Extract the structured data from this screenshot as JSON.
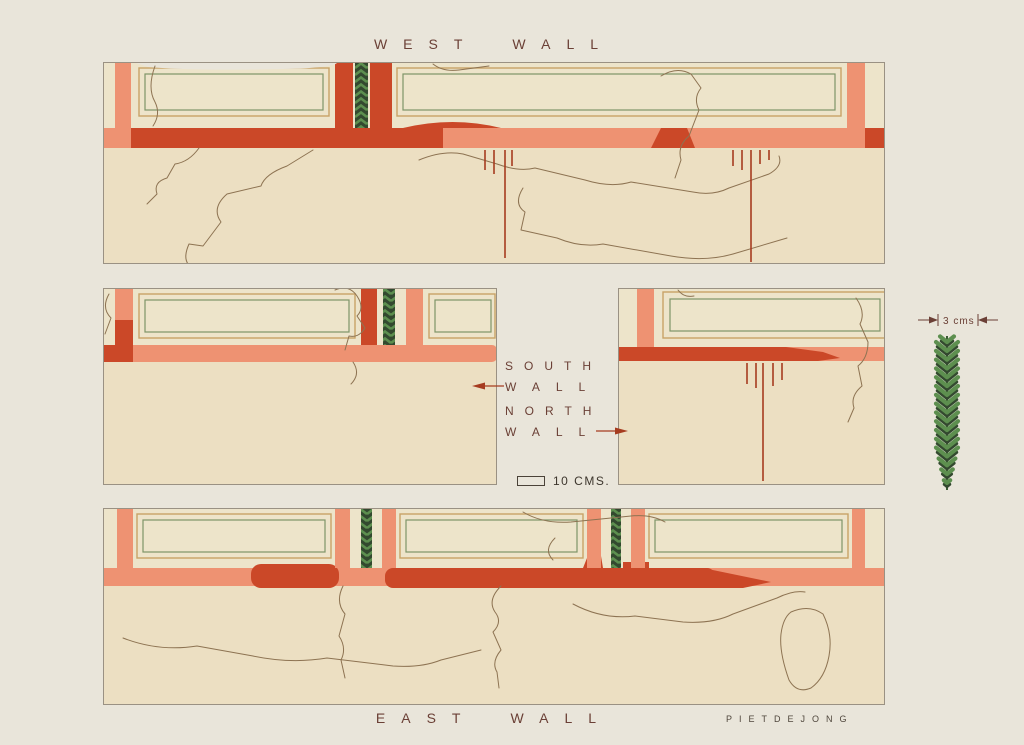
{
  "labels": {
    "west_wall": [
      "WEST",
      "WALL"
    ],
    "east_wall": [
      "EAST",
      "WALL"
    ],
    "south_wall": [
      "SOUTH",
      "WALL"
    ],
    "north_wall": [
      "NORTH",
      "WALL"
    ],
    "scale_text": "10 CMS.",
    "detail_scale_text": "3 cms",
    "signature": "PIETDEJONG"
  },
  "palette": {
    "page_bg": "#e9e5da",
    "gap_bg": "#edebe2",
    "plaster": "#ecdfc2",
    "panel_cream": "#ede4ca",
    "salmon": "#ee9272",
    "vermillion": "#cb4828",
    "deep_red": "#a63c20",
    "green_line": "#7e9468",
    "leaf_green": "#5d8f4f",
    "leaf_dark": "#33492f",
    "tan_line": "#c8a266",
    "outline": "#8d7352",
    "text_maroon": "#6b4036",
    "signature": "#4f463c",
    "pencil": "#9a9183"
  }
}
